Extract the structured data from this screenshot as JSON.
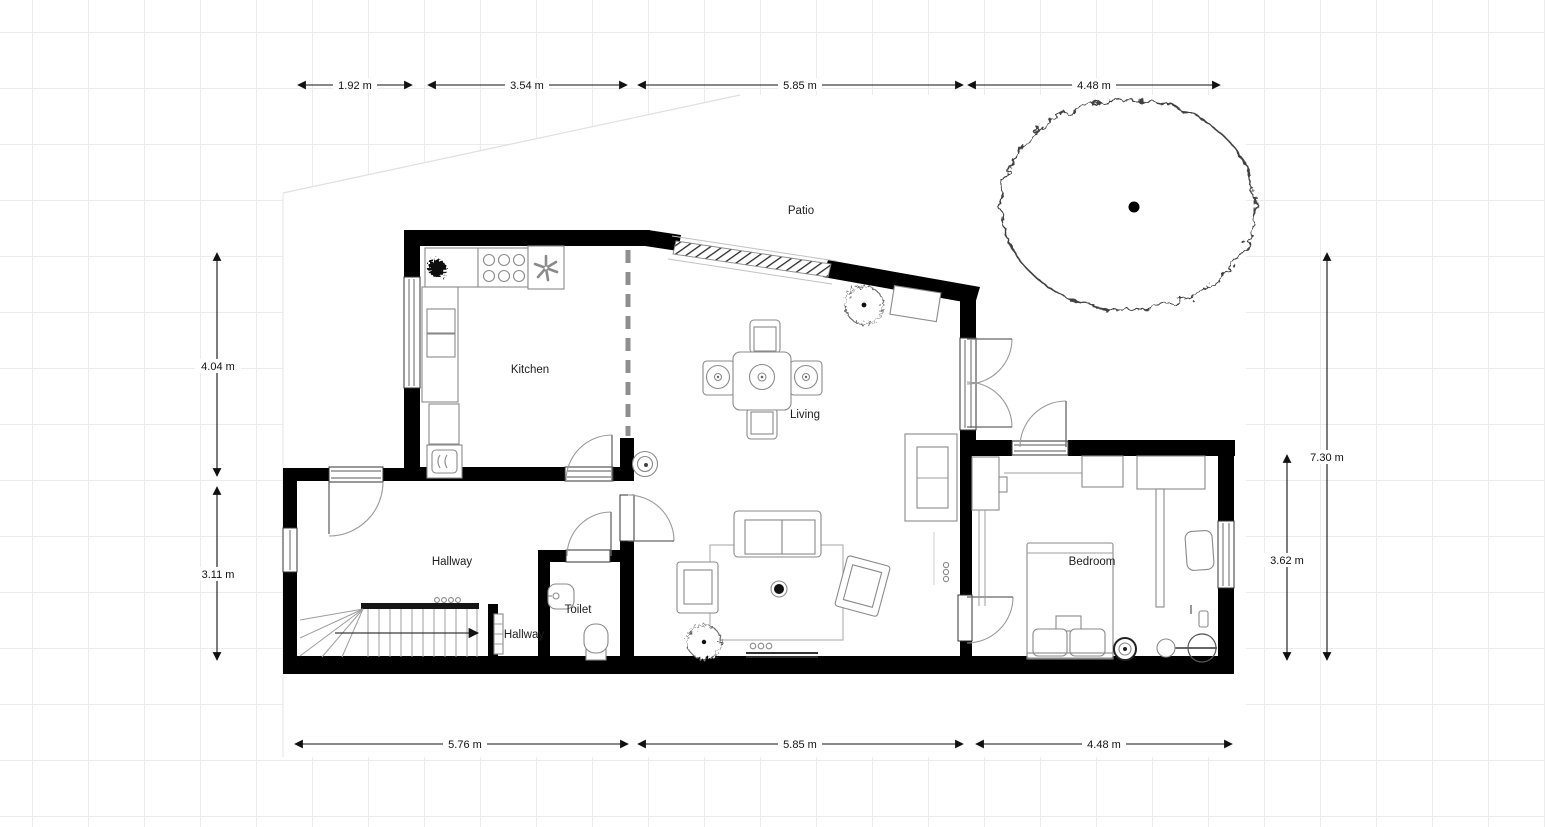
{
  "canvas": {
    "background": "#ffffff",
    "grid_color": "#ececec",
    "wall_color": "#000000",
    "furniture_line_color": "#8a8a8a"
  },
  "floor_plan": {
    "room_labels": [
      {
        "id": "patio",
        "label": "Patio"
      },
      {
        "id": "kitchen",
        "label": "Kitchen"
      },
      {
        "id": "living",
        "label": "Living"
      },
      {
        "id": "hallway",
        "label": "Hallway"
      },
      {
        "id": "toilet",
        "label": "Toilet"
      },
      {
        "id": "hallway-landing",
        "label": "Hallway"
      },
      {
        "id": "bedroom",
        "label": "Bedroom"
      }
    ],
    "dimensions": {
      "top": [
        "1.92 m",
        "3.54 m",
        "5.85 m",
        "4.48 m"
      ],
      "bottom": [
        "5.76 m",
        "5.85 m",
        "4.48 m"
      ],
      "left": [
        "4.04 m",
        "3.11 m"
      ],
      "right": [
        "7.30 m",
        "3.62 m"
      ]
    }
  }
}
